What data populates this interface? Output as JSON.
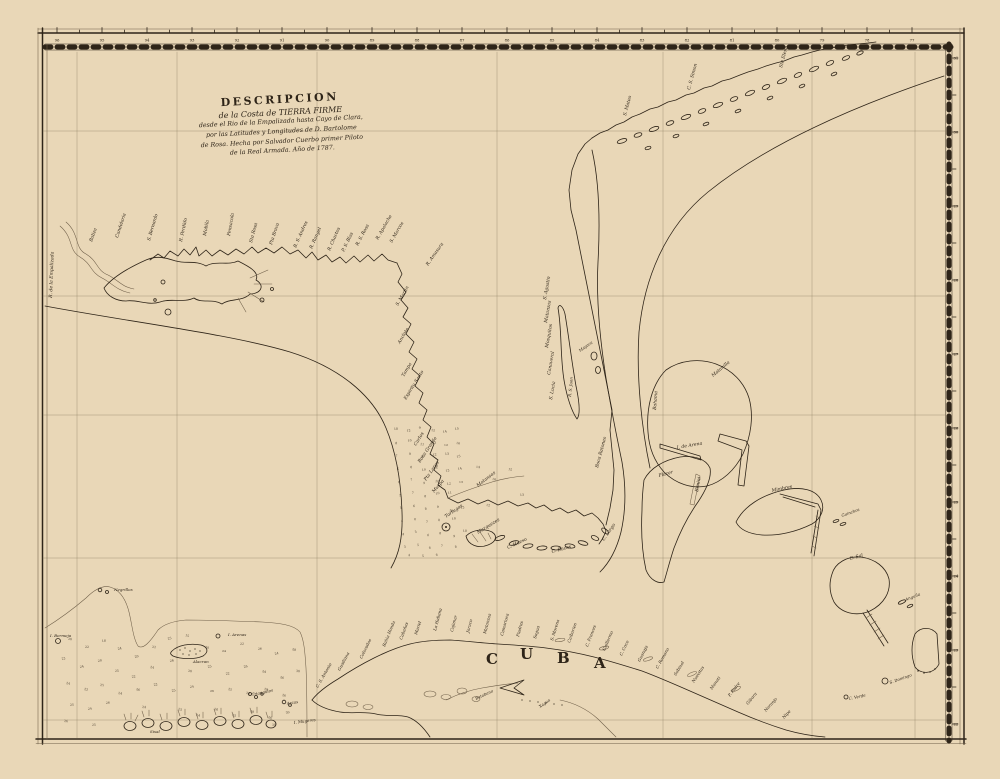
{
  "map": {
    "colors": {
      "paper": "#e9d7b7",
      "ink": "#2e2418",
      "faint_line": "#6f5f49"
    },
    "title_block": {
      "lines": [
        "DESCRIPCION",
        "de la Costa de TIERRA FIRME",
        "desde el Rio de la Empalizada hasta Cayo de Clara,",
        "por las Latitudes y Longitudes de D. Bartolome",
        "de Rosa. Hecha por Salvador Cuerbo primer Piloto",
        "de la Real Armada. Año de 1787."
      ]
    },
    "cuba": {
      "letters": [
        {
          "ch": "C",
          "x": 486,
          "y": 664
        },
        {
          "ch": "U",
          "x": 520,
          "y": 659
        },
        {
          "ch": "B",
          "x": 557,
          "y": 663
        },
        {
          "ch": "A",
          "x": 594,
          "y": 668
        }
      ]
    },
    "border": {
      "top_ticks": {
        "start_x": 57,
        "step": 45,
        "values": [
          "96",
          "95",
          "94",
          "93",
          "92",
          "91",
          "90",
          "89",
          "88",
          "87",
          "86",
          "85",
          "84",
          "83",
          "82",
          "81",
          "80",
          "79",
          "78",
          "77"
        ]
      },
      "right_ticks": {
        "start_y": 58,
        "step": 74,
        "values": [
          "31",
          "30",
          "29",
          "28",
          "27",
          "26",
          "25",
          "24",
          "23",
          "22"
        ]
      }
    },
    "labels": [
      {
        "t": "R. de la Empalizada",
        "x": 52,
        "y": 298,
        "r": -88
      },
      {
        "t": "Baliza",
        "x": 92,
        "y": 242,
        "r": -70
      },
      {
        "t": "Candelaria",
        "x": 118,
        "y": 238,
        "r": -72
      },
      {
        "t": "S. Bernardo",
        "x": 150,
        "y": 241,
        "r": -74
      },
      {
        "t": "R. Perdido",
        "x": 182,
        "y": 242,
        "r": -78
      },
      {
        "t": "Mobila",
        "x": 206,
        "y": 236,
        "r": -80
      },
      {
        "t": "Pensacola",
        "x": 230,
        "y": 236,
        "r": -80
      },
      {
        "t": "Sta Rosa",
        "x": 252,
        "y": 243,
        "r": -75
      },
      {
        "t": "Pta Brava",
        "x": 272,
        "y": 245,
        "r": -72
      },
      {
        "t": "B. S. Andres",
        "x": 296,
        "y": 248,
        "r": -66
      },
      {
        "t": "R. Rangel",
        "x": 312,
        "y": 249,
        "r": -66
      },
      {
        "t": "R. Chactos",
        "x": 330,
        "y": 251,
        "r": -66
      },
      {
        "t": "P. S. Blas",
        "x": 344,
        "y": 252,
        "r": -64
      },
      {
        "t": "R. S. Rosa",
        "x": 358,
        "y": 246,
        "r": -62
      },
      {
        "t": "R. Apalache",
        "x": 378,
        "y": 240,
        "r": -60
      },
      {
        "t": "S. Marcos",
        "x": 392,
        "y": 243,
        "r": -60
      },
      {
        "t": "R. Amasura",
        "x": 428,
        "y": 266,
        "r": -55
      },
      {
        "t": "S. Martin",
        "x": 398,
        "y": 306,
        "r": -60
      },
      {
        "t": "Anclote",
        "x": 400,
        "y": 344,
        "r": -60
      },
      {
        "t": "Tampa",
        "x": 404,
        "y": 377,
        "r": -60
      },
      {
        "t": "Espiritu Santo",
        "x": 406,
        "y": 400,
        "r": -58
      },
      {
        "t": "Carlos",
        "x": 416,
        "y": 446,
        "r": -58
      },
      {
        "t": "Boca Grande",
        "x": 420,
        "y": 463,
        "r": -56
      },
      {
        "t": "Pta Larga",
        "x": 426,
        "y": 481,
        "r": -55
      },
      {
        "t": "Muspa",
        "x": 434,
        "y": 493,
        "r": -50
      },
      {
        "t": "Matansas",
        "x": 478,
        "y": 487,
        "r": -38
      },
      {
        "t": "Tortugas",
        "x": 446,
        "y": 518,
        "r": -35
      },
      {
        "t": "Marquezes",
        "x": 478,
        "y": 534,
        "r": -32
      },
      {
        "t": "C. Hueso",
        "x": 508,
        "y": 549,
        "r": -25
      },
      {
        "t": "C. Bacas",
        "x": 552,
        "y": 553,
        "r": -15
      },
      {
        "t": "C. Largo",
        "x": 604,
        "y": 541,
        "r": -55
      },
      {
        "t": "S. Agustin",
        "x": 546,
        "y": 300,
        "r": -80
      },
      {
        "t": "Matanzas",
        "x": 547,
        "y": 323,
        "r": -80
      },
      {
        "t": "Mosquitos",
        "x": 548,
        "y": 348,
        "r": -80
      },
      {
        "t": "Canaveral",
        "x": 550,
        "y": 375,
        "r": -80
      },
      {
        "t": "S. Lucia",
        "x": 552,
        "y": 400,
        "r": -80
      },
      {
        "t": "Mayaca",
        "x": 580,
        "y": 352,
        "r": -35,
        "s": 4
      },
      {
        "t": "R. S. Juan",
        "x": 571,
        "y": 397,
        "r": -85,
        "s": 4
      },
      {
        "t": "Boca Ratones",
        "x": 598,
        "y": 468,
        "r": -75
      },
      {
        "t": "S. Mateo",
        "x": 626,
        "y": 116,
        "r": -75
      },
      {
        "t": "C. S. Simon",
        "x": 690,
        "y": 90,
        "r": -75
      },
      {
        "t": "Sta Elena",
        "x": 782,
        "y": 68,
        "r": -75
      },
      {
        "t": "C. S. Antonio",
        "x": 318,
        "y": 688,
        "r": -60,
        "s": 4.2
      },
      {
        "t": "Guadiana",
        "x": 340,
        "y": 671,
        "r": -62,
        "s": 4.2
      },
      {
        "t": "Colorados",
        "x": 362,
        "y": 659,
        "r": -64,
        "s": 4.2
      },
      {
        "t": "Bahia Honda",
        "x": 385,
        "y": 647,
        "r": -68,
        "s": 4.2
      },
      {
        "t": "Cabañas",
        "x": 402,
        "y": 640,
        "r": -70,
        "s": 4.2
      },
      {
        "t": "Mariel",
        "x": 417,
        "y": 635,
        "r": -72,
        "s": 4.2
      },
      {
        "t": "La Habana",
        "x": 436,
        "y": 631,
        "r": -75,
        "s": 4.2
      },
      {
        "t": "Cojimar",
        "x": 453,
        "y": 632,
        "r": -76,
        "s": 4.2
      },
      {
        "t": "Jaruco",
        "x": 469,
        "y": 633,
        "r": -76,
        "s": 4.2
      },
      {
        "t": "Matanzas",
        "x": 486,
        "y": 634,
        "r": -76,
        "s": 4.2
      },
      {
        "t": "Camarioca",
        "x": 503,
        "y": 636,
        "r": -75,
        "s": 4.2
      },
      {
        "t": "Piedras",
        "x": 519,
        "y": 637,
        "r": -75,
        "s": 4.2
      },
      {
        "t": "Sagua",
        "x": 536,
        "y": 639,
        "r": -74,
        "s": 4.2
      },
      {
        "t": "S. Morena",
        "x": 553,
        "y": 641,
        "r": -73,
        "s": 4.2
      },
      {
        "t": "Caibarien",
        "x": 570,
        "y": 643,
        "r": -71,
        "s": 4.2
      },
      {
        "t": "C. Frances",
        "x": 588,
        "y": 647,
        "r": -69,
        "s": 4.2
      },
      {
        "t": "Guillermo",
        "x": 605,
        "y": 651,
        "r": -67,
        "s": 4.2
      },
      {
        "t": "C. Coco",
        "x": 622,
        "y": 656,
        "r": -65,
        "s": 4.2
      },
      {
        "t": "Guanaja",
        "x": 640,
        "y": 662,
        "r": -63,
        "s": 4.2
      },
      {
        "t": "C. Romano",
        "x": 658,
        "y": 669,
        "r": -61,
        "s": 4.2
      },
      {
        "t": "Sabinal",
        "x": 676,
        "y": 676,
        "r": -59,
        "s": 4.2
      },
      {
        "t": "Nuevitas",
        "x": 694,
        "y": 683,
        "r": -57,
        "s": 4.2
      },
      {
        "t": "Manati",
        "x": 712,
        "y": 690,
        "r": -55,
        "s": 4.2
      },
      {
        "t": "P. Padre",
        "x": 730,
        "y": 697,
        "r": -53,
        "s": 4.2
      },
      {
        "t": "Gibara",
        "x": 748,
        "y": 705,
        "r": -51,
        "s": 4.2
      },
      {
        "t": "Naranjo",
        "x": 766,
        "y": 712,
        "r": -49,
        "s": 4.2
      },
      {
        "t": "Nipe",
        "x": 784,
        "y": 719,
        "r": -47,
        "s": 4.2
      },
      {
        "t": "Batabano",
        "x": 476,
        "y": 700,
        "r": -25,
        "s": 4
      },
      {
        "t": "Xagua",
        "x": 540,
        "y": 708,
        "r": -35,
        "s": 4
      },
      {
        "t": "Matanilla",
        "x": 713,
        "y": 377,
        "r": -40
      },
      {
        "t": "Bahama",
        "x": 656,
        "y": 410,
        "r": -86
      },
      {
        "t": "I. de Arena",
        "x": 677,
        "y": 449,
        "r": -10
      },
      {
        "t": "Placer",
        "x": 659,
        "y": 477,
        "r": -15
      },
      {
        "t": "Bimini",
        "x": 698,
        "y": 492,
        "r": -80
      },
      {
        "t": "Mimbres",
        "x": 772,
        "y": 492,
        "r": -12
      },
      {
        "t": "Guinchos",
        "x": 842,
        "y": 517,
        "r": -20,
        "s": 4
      },
      {
        "t": "C. Sal",
        "x": 850,
        "y": 560,
        "r": -15
      },
      {
        "t": "Anguila",
        "x": 906,
        "y": 601,
        "r": -22,
        "s": 4
      },
      {
        "t": "S. Domingo",
        "x": 890,
        "y": 684,
        "r": -20,
        "s": 4
      },
      {
        "t": "C. Verde",
        "x": 849,
        "y": 700,
        "r": -12,
        "s": 4
      },
      {
        "t": "Negrillos",
        "x": 114,
        "y": 591,
        "r": 0,
        "s": 4
      },
      {
        "t": "I. Bermeja",
        "x": 50,
        "y": 637,
        "r": 0,
        "s": 4
      },
      {
        "t": "I. Arenas",
        "x": 228,
        "y": 636,
        "r": 0,
        "s": 4
      },
      {
        "t": "Alacran",
        "x": 193,
        "y": 663,
        "r": 0,
        "s": 4
      },
      {
        "t": "Triangulos",
        "x": 252,
        "y": 696,
        "r": -12,
        "s": 4
      },
      {
        "t": "Arcas",
        "x": 287,
        "y": 705,
        "r": -10,
        "s": 4
      },
      {
        "t": "Sisal",
        "x": 150,
        "y": 733,
        "r": 0,
        "s": 4
      },
      {
        "t": "I. Mugeres",
        "x": 294,
        "y": 724,
        "r": -8,
        "s": 4
      }
    ],
    "soundings": {
      "west_florida": [
        [
          394,
          430,
          "10"
        ],
        [
          407,
          432,
          "12"
        ],
        [
          419,
          429,
          "9"
        ],
        [
          431,
          431,
          "12"
        ],
        [
          443,
          433,
          "14"
        ],
        [
          455,
          430,
          "15"
        ],
        [
          395,
          444,
          "8"
        ],
        [
          408,
          442,
          "10"
        ],
        [
          420,
          445,
          "11"
        ],
        [
          432,
          443,
          "13"
        ],
        [
          444,
          446,
          "12"
        ],
        [
          456,
          444,
          "16"
        ],
        [
          396,
          457,
          "7"
        ],
        [
          409,
          455,
          "9"
        ],
        [
          421,
          458,
          "10"
        ],
        [
          433,
          456,
          "12"
        ],
        [
          445,
          455,
          "13"
        ],
        [
          457,
          458,
          "15"
        ],
        [
          397,
          470,
          "6"
        ],
        [
          410,
          468,
          "8"
        ],
        [
          422,
          471,
          "10"
        ],
        [
          434,
          469,
          "11"
        ],
        [
          446,
          472,
          "12"
        ],
        [
          458,
          470,
          "14"
        ],
        [
          398,
          483,
          "6"
        ],
        [
          411,
          481,
          "7"
        ],
        [
          423,
          484,
          "9"
        ],
        [
          435,
          482,
          "10"
        ],
        [
          447,
          485,
          "12"
        ],
        [
          459,
          483,
          "13"
        ],
        [
          399,
          496,
          "5"
        ],
        [
          412,
          494,
          "7"
        ],
        [
          424,
          497,
          "8"
        ],
        [
          436,
          495,
          "10"
        ],
        [
          448,
          494,
          "11"
        ],
        [
          400,
          509,
          "5"
        ],
        [
          413,
          507,
          "6"
        ],
        [
          425,
          510,
          "8"
        ],
        [
          437,
          508,
          "9"
        ],
        [
          449,
          511,
          "10"
        ],
        [
          461,
          509,
          "12"
        ],
        [
          401,
          522,
          "4"
        ],
        [
          414,
          520,
          "6"
        ],
        [
          426,
          523,
          "7"
        ],
        [
          438,
          521,
          "8"
        ],
        [
          452,
          520,
          "10"
        ],
        [
          402,
          535,
          "4"
        ],
        [
          415,
          533,
          "5"
        ],
        [
          427,
          536,
          "6"
        ],
        [
          439,
          534,
          "8"
        ],
        [
          453,
          537,
          "9"
        ],
        [
          463,
          532,
          "10"
        ],
        [
          404,
          548,
          "3"
        ],
        [
          417,
          546,
          "5"
        ],
        [
          429,
          549,
          "6"
        ],
        [
          441,
          547,
          "7"
        ],
        [
          455,
          548,
          "8"
        ],
        [
          408,
          556,
          "4"
        ],
        [
          422,
          557,
          "5"
        ],
        [
          436,
          556,
          "6"
        ],
        [
          476,
          468,
          "14"
        ],
        [
          492,
          480,
          "16"
        ],
        [
          508,
          470,
          "15"
        ],
        [
          520,
          496,
          "13"
        ],
        [
          486,
          506,
          "12"
        ]
      ],
      "campeche": [
        [
          68,
          640,
          "20"
        ],
        [
          85,
          648,
          "22"
        ],
        [
          102,
          642,
          "18"
        ],
        [
          118,
          650,
          "24"
        ],
        [
          135,
          658,
          "20"
        ],
        [
          152,
          648,
          "22"
        ],
        [
          168,
          640,
          "25"
        ],
        [
          185,
          636,
          "15"
        ],
        [
          205,
          648,
          "20"
        ],
        [
          222,
          652,
          "24"
        ],
        [
          240,
          645,
          "22"
        ],
        [
          258,
          650,
          "26"
        ],
        [
          275,
          655,
          "24"
        ],
        [
          292,
          650,
          "28"
        ],
        [
          62,
          660,
          "22"
        ],
        [
          80,
          668,
          "24"
        ],
        [
          98,
          662,
          "20"
        ],
        [
          115,
          672,
          "25"
        ],
        [
          132,
          678,
          "22"
        ],
        [
          150,
          668,
          "24"
        ],
        [
          170,
          662,
          "26"
        ],
        [
          188,
          672,
          "20"
        ],
        [
          208,
          668,
          "25"
        ],
        [
          226,
          675,
          "22"
        ],
        [
          244,
          668,
          "26"
        ],
        [
          262,
          672,
          "24"
        ],
        [
          280,
          678,
          "26"
        ],
        [
          296,
          672,
          "30"
        ],
        [
          66,
          684,
          "24"
        ],
        [
          84,
          690,
          "22"
        ],
        [
          100,
          686,
          "25"
        ],
        [
          118,
          694,
          "24"
        ],
        [
          136,
          690,
          "26"
        ],
        [
          154,
          686,
          "22"
        ],
        [
          172,
          692,
          "25"
        ],
        [
          190,
          688,
          "24"
        ],
        [
          210,
          692,
          "26"
        ],
        [
          228,
          690,
          "25"
        ],
        [
          246,
          694,
          "24"
        ],
        [
          264,
          690,
          "28"
        ],
        [
          282,
          696,
          "26"
        ],
        [
          70,
          706,
          "25"
        ],
        [
          88,
          710,
          "24"
        ],
        [
          106,
          704,
          "26"
        ],
        [
          142,
          708,
          "24"
        ],
        [
          178,
          710,
          "25"
        ],
        [
          196,
          716,
          "24"
        ],
        [
          214,
          710,
          "26"
        ],
        [
          232,
          716,
          "25"
        ],
        [
          250,
          712,
          "28"
        ],
        [
          268,
          718,
          "26"
        ],
        [
          286,
          714,
          "30"
        ],
        [
          64,
          722,
          "26"
        ],
        [
          92,
          726,
          "25"
        ],
        [
          272,
          726,
          "30"
        ]
      ]
    }
  }
}
